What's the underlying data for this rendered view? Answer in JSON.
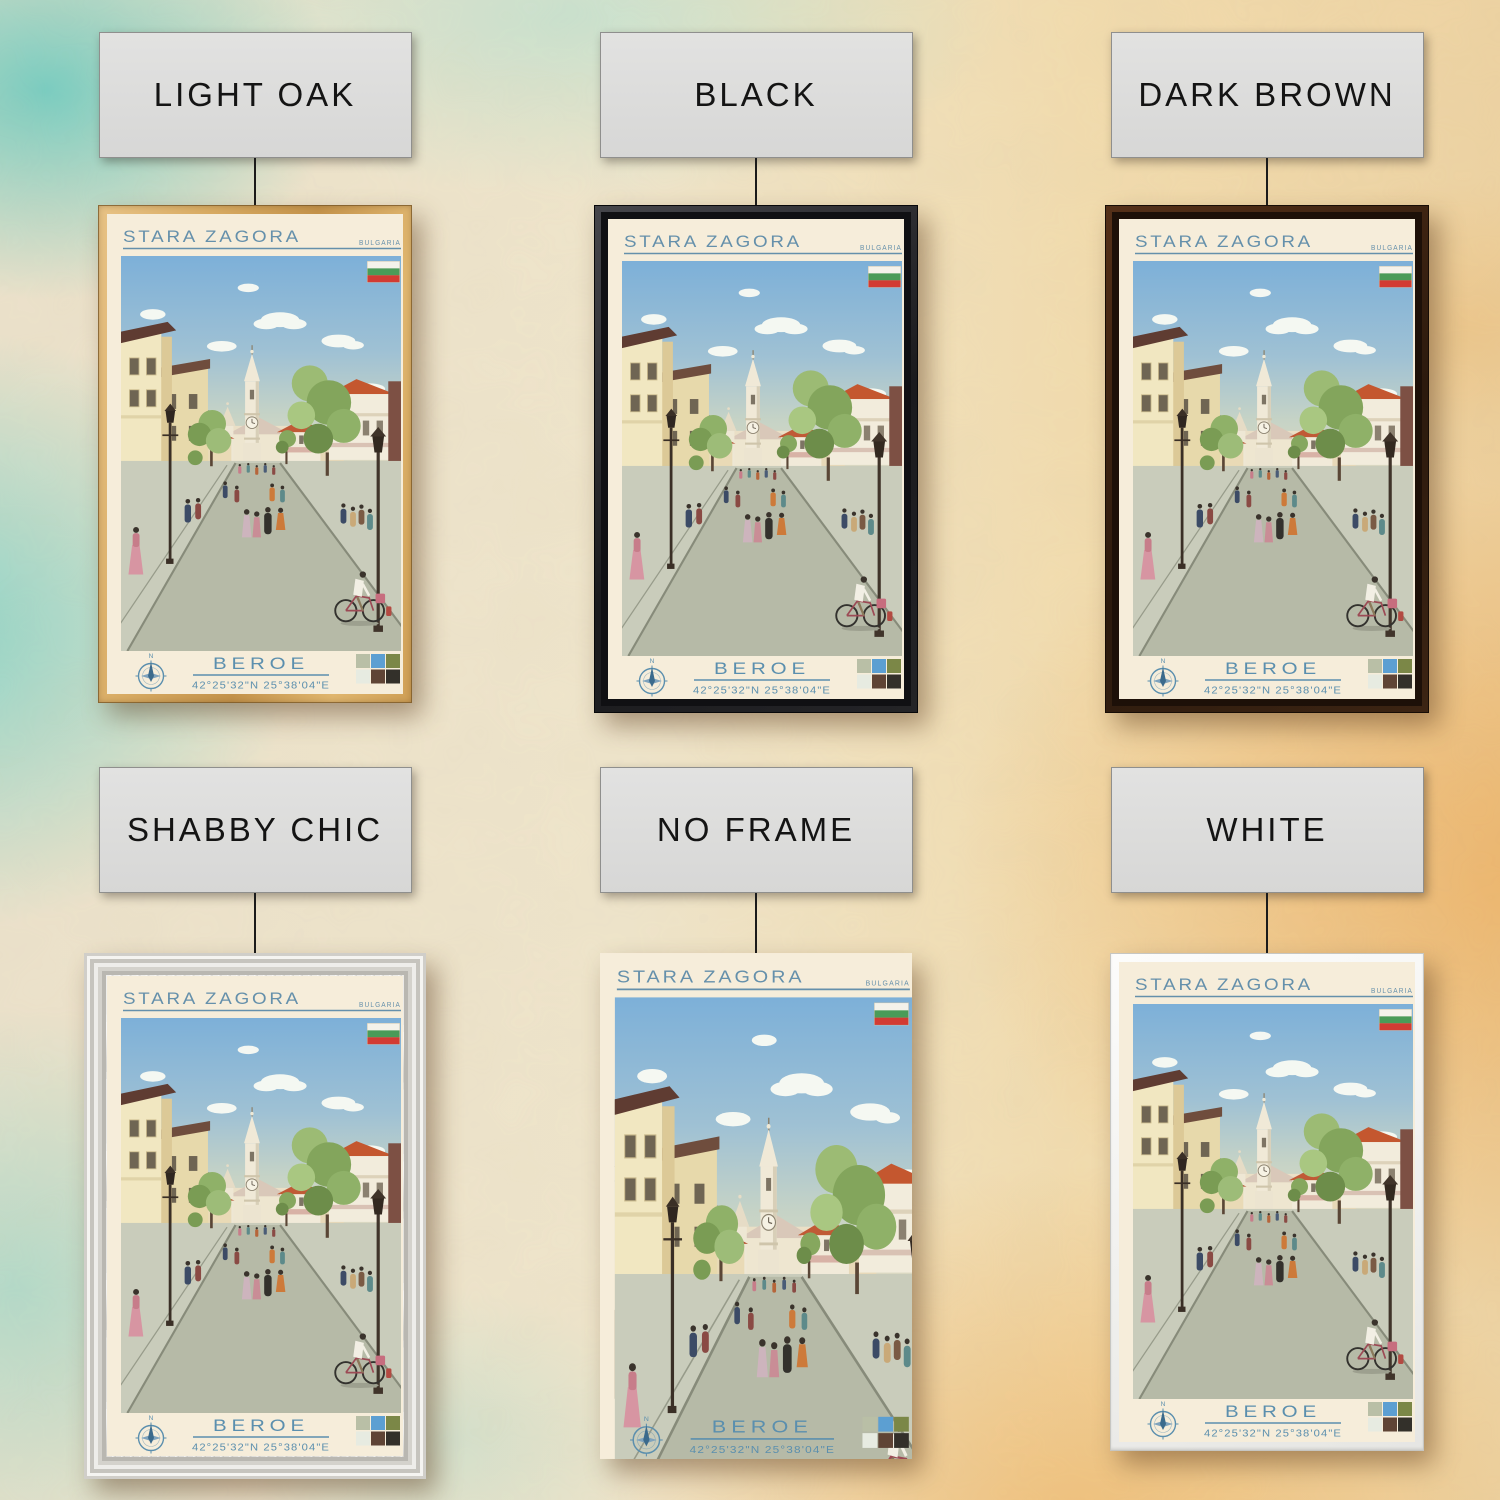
{
  "page": {
    "description": "Framed travel poster product collage showing six frame options"
  },
  "options": [
    {
      "id": "light-oak",
      "label": "LIGHT OAK"
    },
    {
      "id": "black",
      "label": "BLACK"
    },
    {
      "id": "dark-brown",
      "label": "DARK BROWN"
    },
    {
      "id": "shabby-chic",
      "label": "SHABBY CHIC"
    },
    {
      "id": "no-frame",
      "label": "NO FRAME"
    },
    {
      "id": "white",
      "label": "WHITE"
    }
  ],
  "poster": {
    "title": "STARA ZAGORA",
    "country": "BULGARIA",
    "team": "BEROE",
    "coordinates": "42°25'32\"N 25°38'04\"E",
    "compass_north": "N",
    "accent_color": "#6590ab",
    "paper_color": "#f6edda",
    "flag_colors": {
      "white": "#f4f2ea",
      "green": "#4a9b58",
      "red": "#d23b33"
    },
    "palette": [
      "#b9bfa6",
      "#5c9fd2",
      "#7b8747",
      "#e7ebe1",
      "#5f4435",
      "#33302a"
    ]
  }
}
